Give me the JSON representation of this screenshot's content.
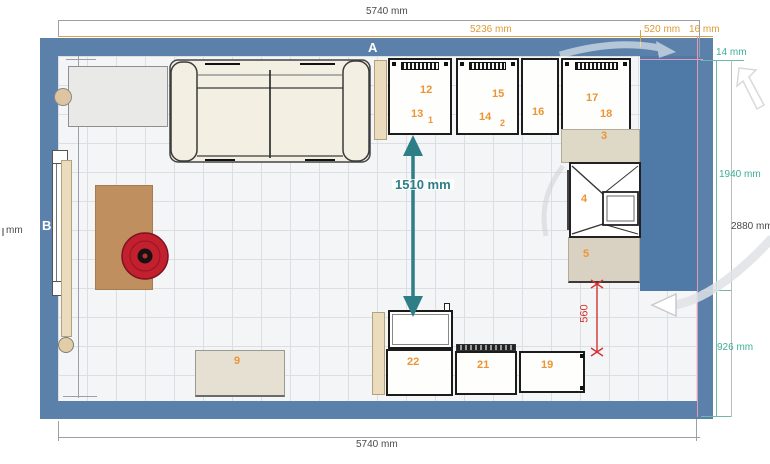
{
  "plan": {
    "wall_labels": {
      "a": "A",
      "b": "B"
    },
    "dims": {
      "top_total": "5740 mm",
      "top_main": "5236 mm",
      "top_right": "520 mm",
      "top_corner": "16 mm",
      "right_top_gap": "14 mm",
      "right_upper": "1940 mm",
      "right_total": "2880 mm",
      "right_lower": "926 mm",
      "bottom_total": "5740 mm",
      "left_partial": "mm",
      "clearance_main": "1510 mm",
      "clearance_small": "560"
    },
    "items": {
      "n12": "12",
      "n13": "13",
      "n1": "1",
      "n15": "15",
      "n14": "14",
      "n2": "2",
      "n16": "16",
      "n17": "17",
      "n18": "18",
      "n3": "3",
      "n4": "4",
      "n5": "5",
      "n9": "9",
      "n22": "22",
      "n21": "21",
      "n19": "19"
    },
    "colors": {
      "wall": "#5b81ab",
      "accent_orange": "#e8922f",
      "dim_teal": "#3fae96",
      "arrow_teal": "#2d7e87",
      "dim_red": "#d23334",
      "guide_pink": "#e79ab8",
      "floor": "#f4f5f6",
      "grid": "#dcdee1"
    }
  }
}
